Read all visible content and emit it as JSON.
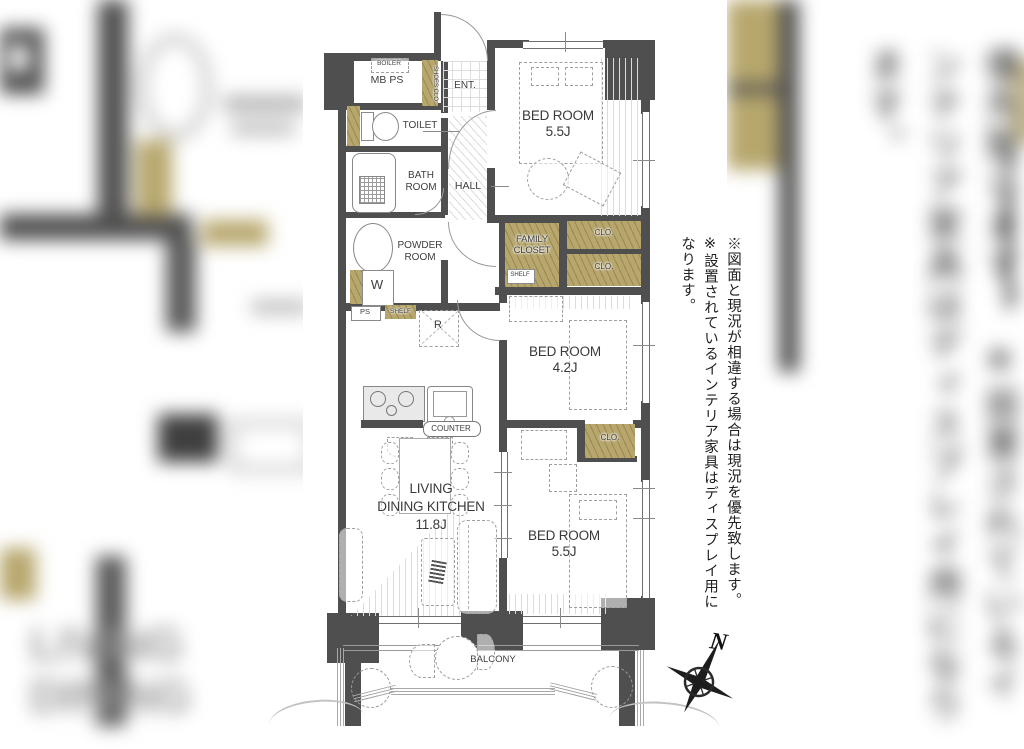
{
  "plan": {
    "labels": {
      "boiler": "BOILER",
      "mbps": "MB PS",
      "shoes_clo": "SHOES CLO.",
      "ent": "ENT.",
      "toilet": "TOILET",
      "bath1": "BATH",
      "bath2": "ROOM",
      "hall": "HALL",
      "powder1": "POWDER",
      "powder2": "ROOM",
      "washer": "W",
      "ps": "PS",
      "shelf": "SHELF",
      "fridge": "R",
      "family1": "FAMILY",
      "family2": "CLOSET",
      "family_shelf": "SHELF",
      "clo1": "CLO.",
      "clo2": "CLO.",
      "clo3": "CLO.",
      "bed1a": "BED ROOM",
      "bed1b": "5.5J",
      "bed2a": "BED ROOM",
      "bed2b": "4.2J",
      "bed3a": "BED ROOM",
      "bed3b": "5.5J",
      "ldk1": "LIVING",
      "ldk2": "DINING KITCHEN",
      "ldk3": "11.8J",
      "counter": "COUNTER",
      "balcony": "BALCONY"
    },
    "compass": {
      "north": "N"
    },
    "notes": {
      "line1": "※図面と現況が相違する場合は現況を優先致します。",
      "line2": "※設置されているインテリア家具はディスプレイ用になります。"
    },
    "colors": {
      "wall": "#4f4f4f",
      "closet": "#b7a76d",
      "line": "#9a9a9a",
      "text": "#3e3e3e"
    }
  },
  "background": {
    "blur_text": "LIVING DINING"
  }
}
